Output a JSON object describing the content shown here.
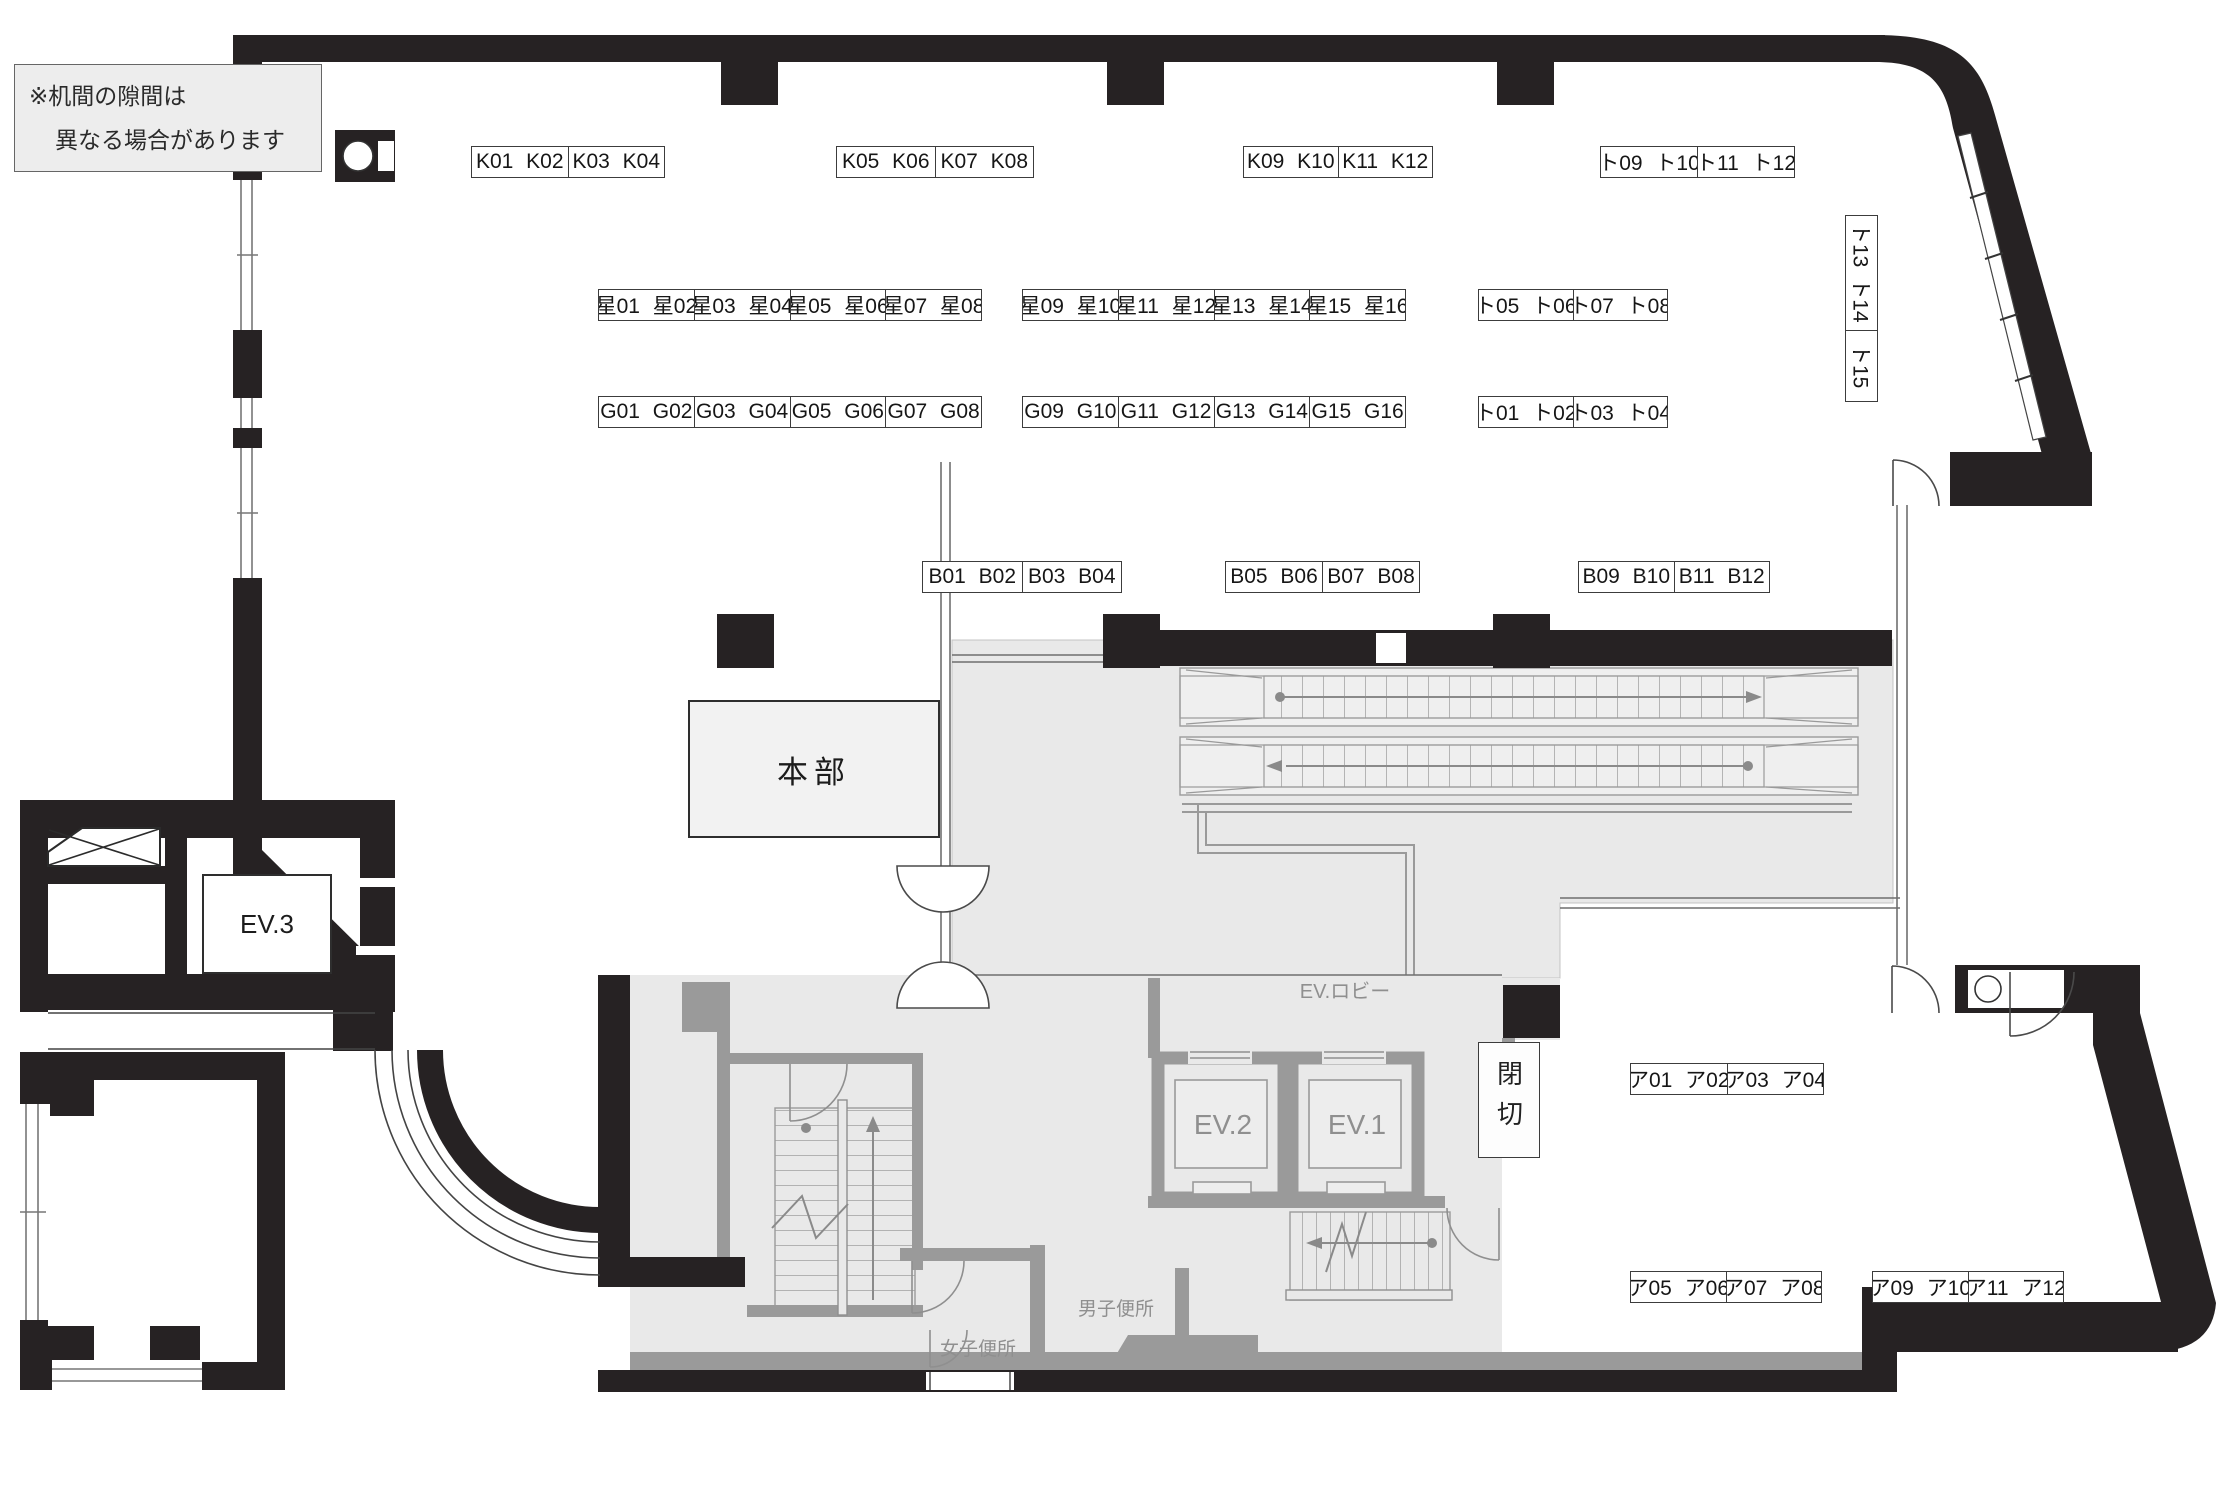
{
  "title": "フロア配置図",
  "colors": {
    "wall": "#262223",
    "floor_gray": "#e9e9e9",
    "partition_gray": "#9a9a9a",
    "note_bg": "#ededed",
    "label_border": "#3c3c3c",
    "muted_text": "#8f8f8f"
  },
  "note": {
    "line1": "※机間の隙間は",
    "line2": "異なる場合があります"
  },
  "rooms": {
    "honbu": {
      "label": "本部"
    },
    "ev1": {
      "label": "EV.1"
    },
    "ev2": {
      "label": "EV.2"
    },
    "ev3": {
      "label": "EV.3"
    },
    "closed": {
      "label": "閉切"
    },
    "ev_lobby": {
      "label": "EV.ロビー"
    },
    "mens_toilet": {
      "label": "男子便所"
    },
    "womens_toilet": {
      "label": "女子便所"
    }
  },
  "label_groups": [
    {
      "name": "K01-K04",
      "x": 471,
      "y": 146,
      "w": 194,
      "h": 32,
      "cells": [
        "K01 K02",
        "K03 K04"
      ]
    },
    {
      "name": "K05-K08",
      "x": 836,
      "y": 146,
      "w": 198,
      "h": 32,
      "cells": [
        "K05 K06",
        "K07 K08"
      ]
    },
    {
      "name": "K09-K12",
      "x": 1243,
      "y": 146,
      "w": 190,
      "h": 32,
      "cells": [
        "K09 K10",
        "K11 K12"
      ]
    },
    {
      "name": "to09-to12",
      "x": 1600,
      "y": 146,
      "w": 195,
      "h": 32,
      "cells": [
        "ト09 ト10",
        "ト11 ト12"
      ]
    },
    {
      "name": "hoshi01-hoshi08",
      "x": 598,
      "y": 289,
      "w": 384,
      "h": 32,
      "cells": [
        "星01 星02",
        "星03 星04",
        "星05 星06",
        "星07 星08"
      ]
    },
    {
      "name": "hoshi09-hoshi16",
      "x": 1022,
      "y": 289,
      "w": 384,
      "h": 32,
      "cells": [
        "星09 星10",
        "星11 星12",
        "星13 星14",
        "星15 星16"
      ]
    },
    {
      "name": "to05-to08",
      "x": 1478,
      "y": 289,
      "w": 190,
      "h": 32,
      "cells": [
        "ト05 ト06",
        "ト07 ト08"
      ]
    },
    {
      "name": "G01-G08",
      "x": 598,
      "y": 396,
      "w": 384,
      "h": 32,
      "cells": [
        "G01 G02",
        "G03 G04",
        "G05 G06",
        "G07 G08"
      ]
    },
    {
      "name": "G09-G16",
      "x": 1022,
      "y": 396,
      "w": 384,
      "h": 32,
      "cells": [
        "G09 G10",
        "G11 G12",
        "G13 G14",
        "G15 G16"
      ]
    },
    {
      "name": "to01-to04",
      "x": 1478,
      "y": 396,
      "w": 190,
      "h": 32,
      "cells": [
        "ト01 ト02",
        "ト03 ト04"
      ]
    },
    {
      "name": "to13-to15",
      "x": 1845,
      "y": 215,
      "w": 33,
      "h": 187,
      "vertical": true,
      "cell_sizes": [
        114,
        71
      ],
      "cells": [
        "ト13 ト14",
        "ト15"
      ]
    },
    {
      "name": "B01-B04",
      "x": 922,
      "y": 561,
      "w": 200,
      "h": 32,
      "cells": [
        "B01 B02",
        "B03 B04"
      ]
    },
    {
      "name": "B05-B08",
      "x": 1225,
      "y": 561,
      "w": 195,
      "h": 32,
      "cells": [
        "B05 B06",
        "B07 B08"
      ]
    },
    {
      "name": "B09-B12",
      "x": 1578,
      "y": 561,
      "w": 192,
      "h": 32,
      "cells": [
        "B09 B10",
        "B11 B12"
      ]
    },
    {
      "name": "a01-a04",
      "x": 1630,
      "y": 1063,
      "w": 194,
      "h": 32,
      "cells": [
        "ア01 ア02",
        "ア03 ア04"
      ]
    },
    {
      "name": "a05-a08",
      "x": 1630,
      "y": 1271,
      "w": 192,
      "h": 32,
      "cells": [
        "ア05 ア06",
        "ア07 ア08"
      ]
    },
    {
      "name": "a09-a12",
      "x": 1872,
      "y": 1271,
      "w": 192,
      "h": 32,
      "cells": [
        "ア09 ア10",
        "ア11 ア12"
      ]
    }
  ]
}
